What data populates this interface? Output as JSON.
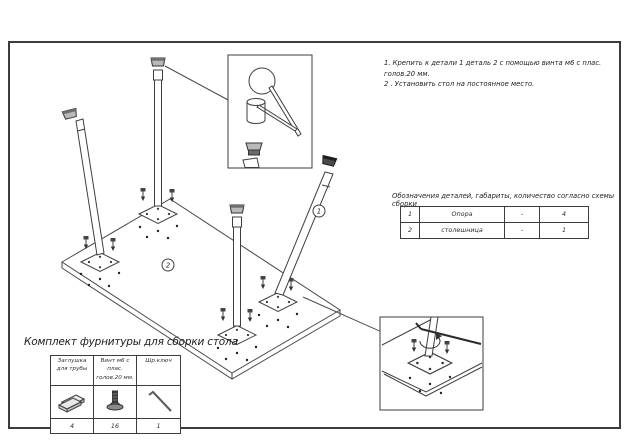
{
  "colors": {
    "ink": "#3a3a3a",
    "paper": "#ffffff",
    "cap_dark": "#3f3f3f",
    "cap_gray": "#a8a8a8"
  },
  "assembly_notes": {
    "line1": "1. Крепить к детали 1 деталь 2 с помощью винта м6 с плас. голов.20 мм.",
    "line2": "2 . Установить стол на постоянное место."
  },
  "parts_list": {
    "caption": "Обозначения деталей, габариты, количество согласно схемы сборки",
    "rows": [
      {
        "num": "1",
        "name": "Опора",
        "dim": "-",
        "qty": "4"
      },
      {
        "num": "2",
        "name": "столешница",
        "dim": "-",
        "qty": "1"
      }
    ]
  },
  "hardware_kit": {
    "title": "Комплект фурнитуры для сборки стола",
    "items": [
      {
        "label": "Заглушка для трубы",
        "qty": "4",
        "icon": "pipe-plug-icon"
      },
      {
        "label": "Винт м6 с плас. голов.20 мм.",
        "qty": "16",
        "icon": "screw-icon"
      },
      {
        "label": "Шр.ключ",
        "qty": "1",
        "icon": "hex-key-icon"
      }
    ]
  },
  "callouts": {
    "support": "1",
    "tabletop": "2"
  }
}
